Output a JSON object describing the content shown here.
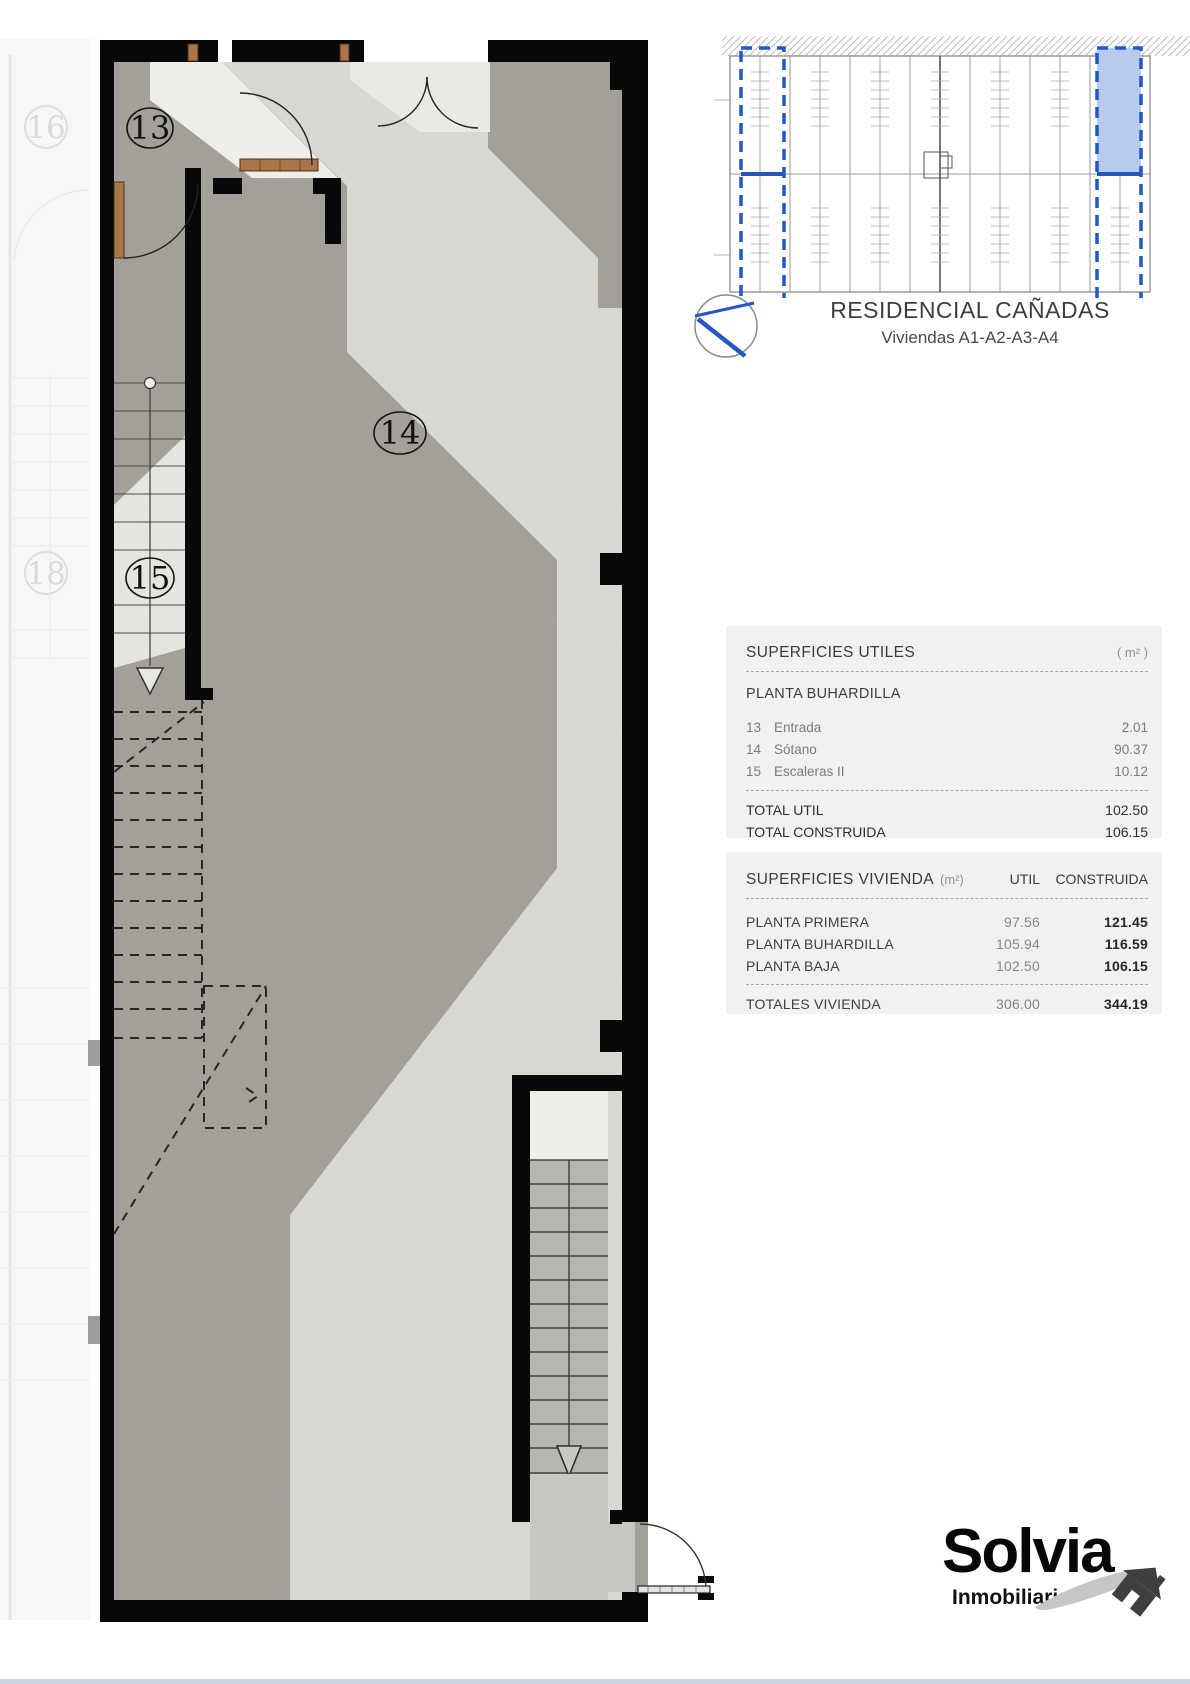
{
  "key_plan": {
    "title": "RESIDENCIAL CAÑADAS",
    "subtitle": "Viviendas A1-A2-A3-A4",
    "accent_color": "#2457c5",
    "highlight_fill": "#b7cbf0"
  },
  "plan": {
    "labels": {
      "l13": "13",
      "l14": "14",
      "l15": "15",
      "g16": "16",
      "g18": "18"
    }
  },
  "tables": {
    "utiles": {
      "title": "SUPERFICIES UTILES",
      "unit_header": "( m² )",
      "section": "PLANTA BUHARDILLA",
      "rows": [
        {
          "num": "13",
          "name": "Entrada",
          "value": "2.01"
        },
        {
          "num": "14",
          "name": "Sótano",
          "value": "90.37"
        },
        {
          "num": "15",
          "name": "Escaleras II",
          "value": "10.12"
        }
      ],
      "totals": [
        {
          "label": "TOTAL UTIL",
          "value": "102.50"
        },
        {
          "label": "TOTAL CONSTRUIDA",
          "value": "106.15"
        }
      ]
    },
    "vivienda": {
      "title": "SUPERFICIES VIVIENDA",
      "title_unit": "(m²)",
      "col_util": "UTIL",
      "col_construida": "CONSTRUIDA",
      "rows": [
        {
          "label": "PLANTA PRIMERA",
          "util": "97.56",
          "construida": "121.45"
        },
        {
          "label": "PLANTA BUHARDILLA",
          "util": "105.94",
          "construida": "116.59"
        },
        {
          "label": "PLANTA BAJA",
          "util": "102.50",
          "construida": "106.15"
        }
      ],
      "total": {
        "label": "TOTALES VIVIENDA",
        "util": "306.00",
        "construida": "344.19"
      }
    }
  },
  "logo": {
    "name": "Solvia",
    "tagline": "Inmobiliaria"
  }
}
